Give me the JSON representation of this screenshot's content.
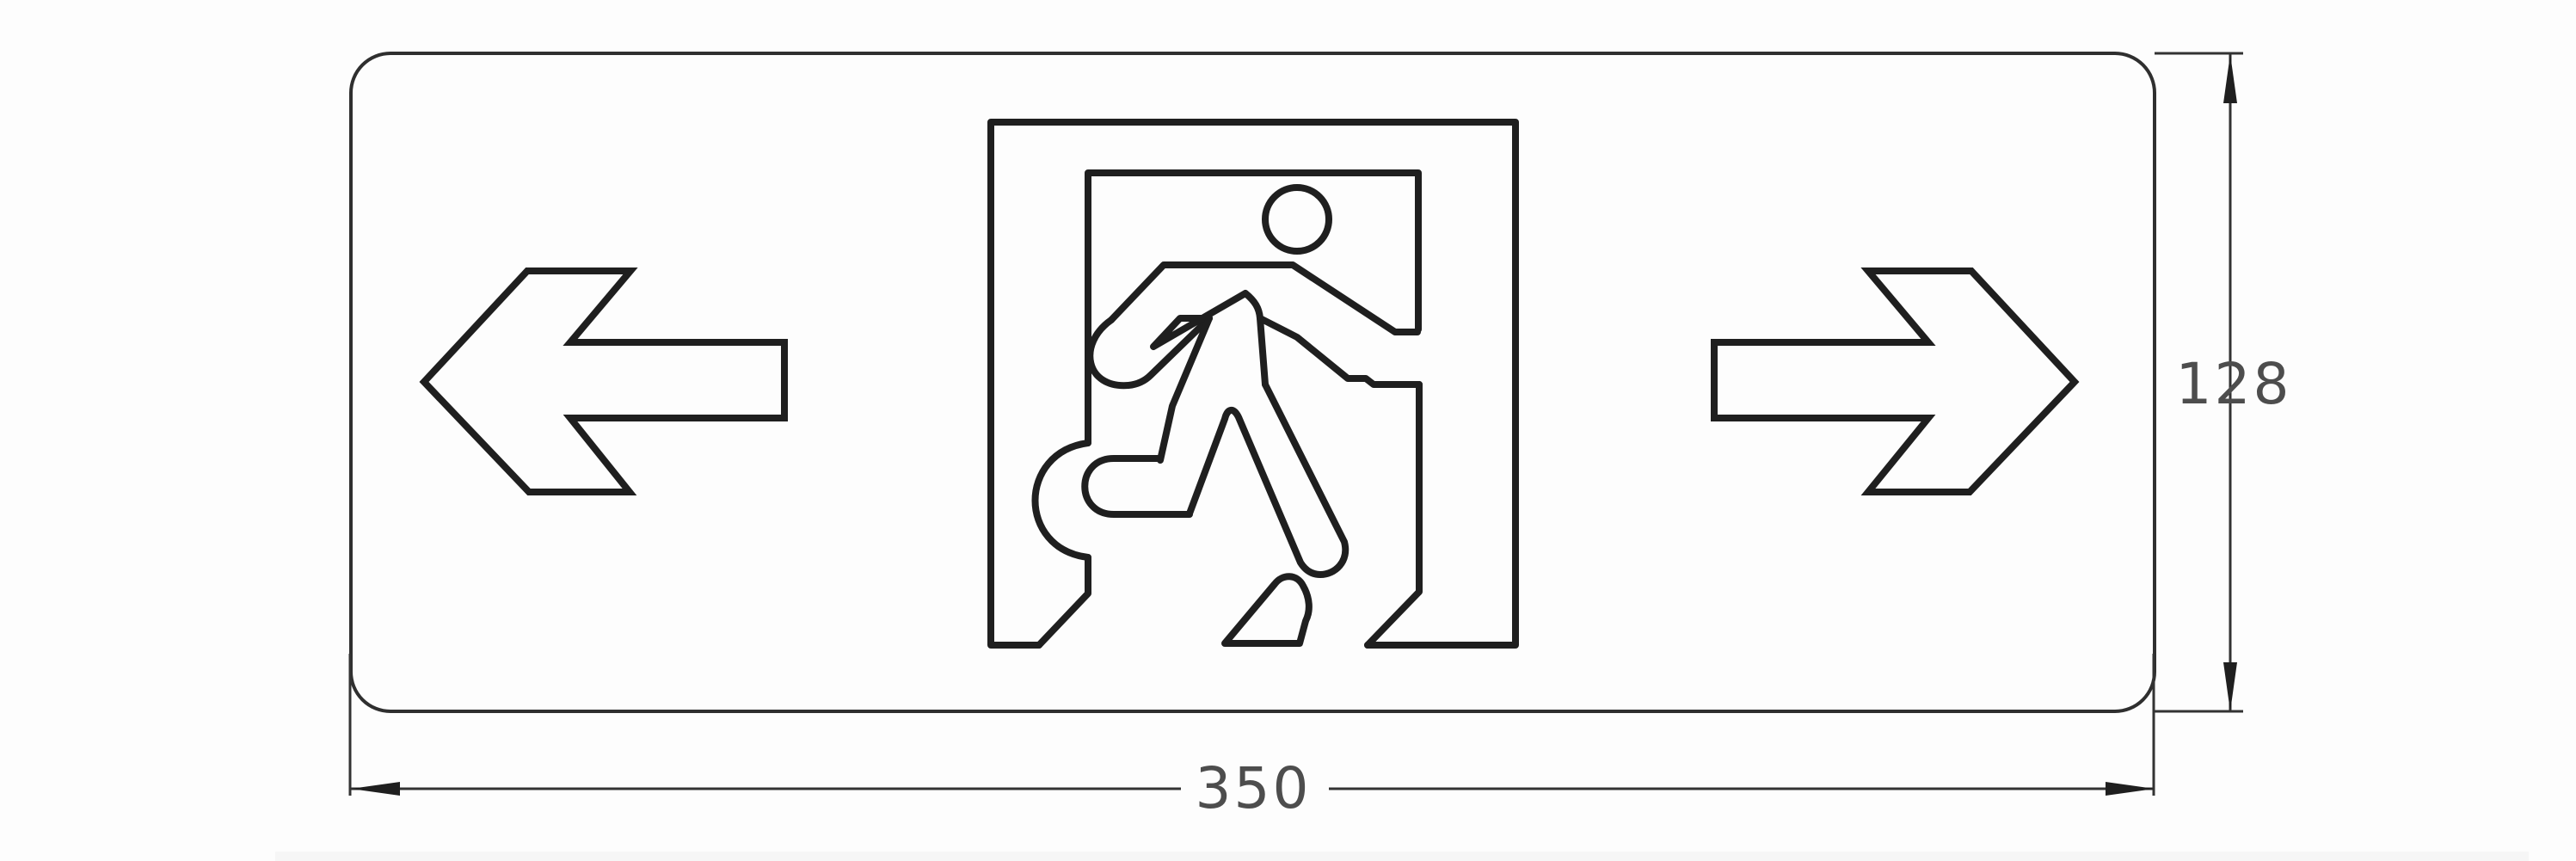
{
  "drawing": {
    "kind": "technical dimension drawing",
    "subject": "emergency exit sign panel with running-man door pictogram and left/right direction arrows",
    "dimensions": {
      "width_label": "350",
      "height_label": "128"
    },
    "symbols": [
      "left-arrow",
      "exit-door-running-man",
      "right-arrow"
    ],
    "colors": {
      "line": "#1f1f1f",
      "panel_border": "#2f2f2f",
      "dimension_line": "#333333",
      "dimension_text": "#4d4d4d",
      "background": "#fdfdfd",
      "bottom_strip": "#f6f6f6"
    }
  }
}
